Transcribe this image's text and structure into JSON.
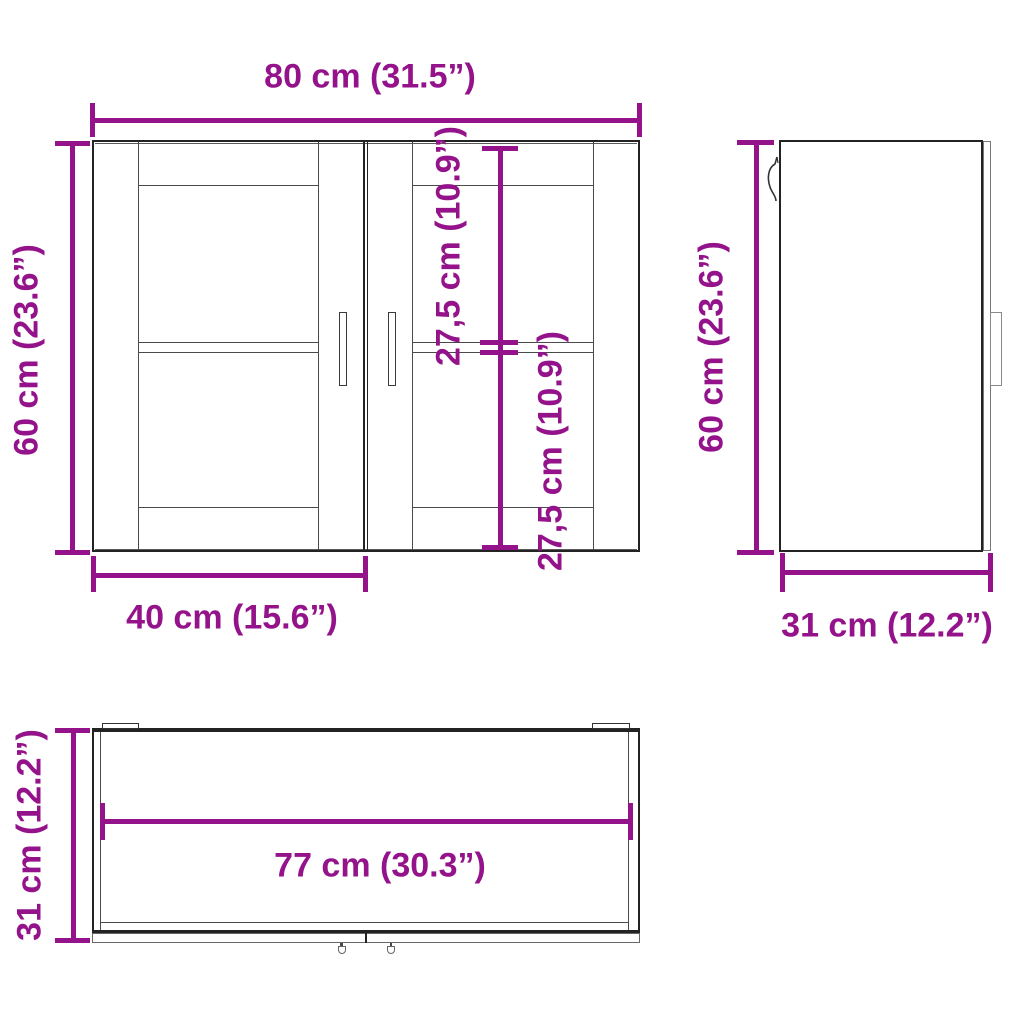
{
  "diagram": {
    "product": "wall-cabinet-dimension-drawing",
    "colors": {
      "dimension": "#94138B",
      "outline": "#232323"
    },
    "views": {
      "front": {
        "width_label": "80 cm (31.5”)",
        "height_label": "60 cm (23.6”)",
        "upper_section_label": "27,5 cm (10.9”)",
        "lower_section_label": "27,5 cm (10.9”)",
        "door_width_label": "40 cm (15.6”)"
      },
      "side": {
        "height_label": "60 cm (23.6”)",
        "depth_label": "31 cm (12.2”)"
      },
      "top": {
        "depth_label": "31 cm (12.2”)",
        "inner_width_label": "77 cm (30.3”)"
      }
    },
    "dimensions": [
      {
        "name": "overall width",
        "cm": 80,
        "inch": 31.5
      },
      {
        "name": "overall height",
        "cm": 60,
        "inch": 23.6
      },
      {
        "name": "overall depth",
        "cm": 31,
        "inch": 12.2
      },
      {
        "name": "door width",
        "cm": 40,
        "inch": 15.6
      },
      {
        "name": "upper compartment height",
        "cm": 27.5,
        "inch": 10.9
      },
      {
        "name": "lower compartment height",
        "cm": 27.5,
        "inch": 10.9
      },
      {
        "name": "inner width",
        "cm": 77,
        "inch": 30.3
      }
    ]
  }
}
